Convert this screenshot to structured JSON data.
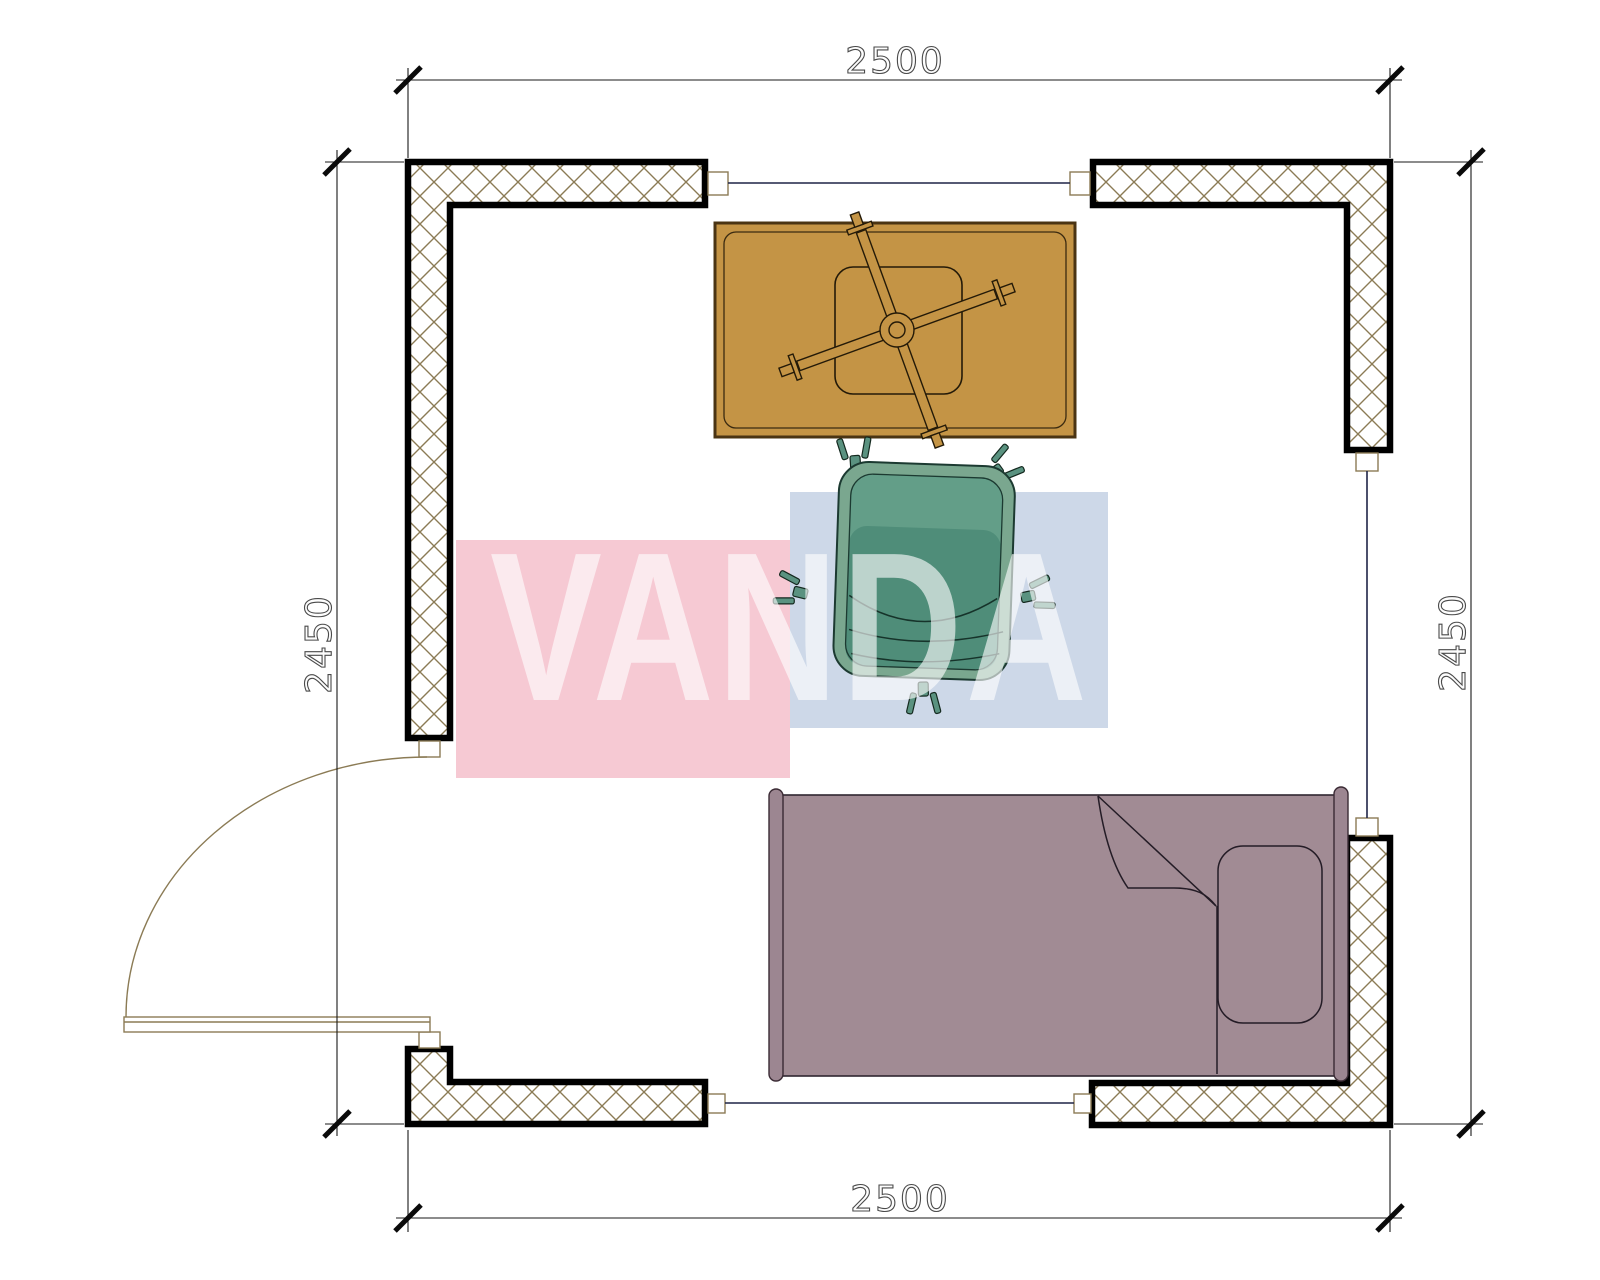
{
  "drawing": {
    "type": "architectural-floor-plan",
    "room_width_label": "2500",
    "room_depth_label": "2450"
  },
  "dimensions": {
    "top": "2500",
    "bottom": "2500",
    "left": "2450",
    "right": "2450"
  },
  "watermark": {
    "text": "VANDA",
    "pink": "#f6c9d3",
    "blue": "#cdd8e8",
    "text_color": "#ffffff"
  },
  "symbols": {
    "table": "table-with-star-base",
    "chair": "office-swivel-chair",
    "bed": "single-bed-with-pillow",
    "door": "door-quarter-swing",
    "window": "window-opening"
  },
  "colors": {
    "table_fill": "#c49445",
    "table_stroke": "#4a3413",
    "table_detail": "#2a1e08",
    "chair_outer": "#7aa78f",
    "chair_band": "#639e88",
    "chair_body": "#4f8d79",
    "chair_caster": "#5a9280",
    "bed_fill": "#a18b94",
    "bed_bar": "#9c8691",
    "bed_stroke": "#2f2630",
    "hatch": "#8b7b55",
    "wall": "#000000",
    "window_line": "#1f2447",
    "door_line": "#8b7b55",
    "dimension_line": "#1a1a1a"
  }
}
